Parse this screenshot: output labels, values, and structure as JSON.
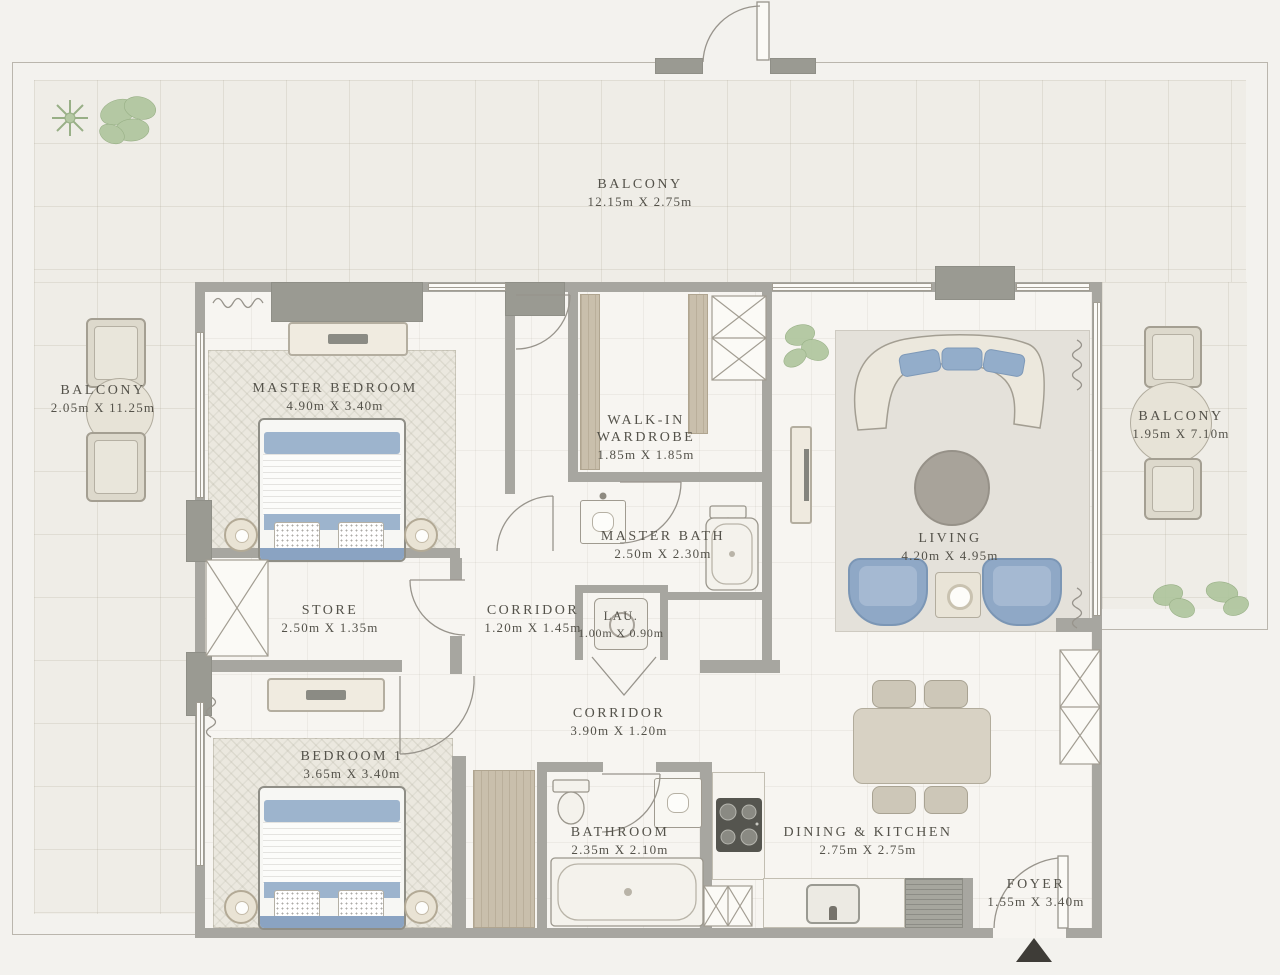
{
  "plan_type": "apartment-floor-plan",
  "rooms": [
    {
      "id": "balcony-top",
      "name": "BALCONY",
      "dims": "12.15m X 2.75m"
    },
    {
      "id": "balcony-left",
      "name": "BALCONY",
      "dims": "2.05m X 11.25m"
    },
    {
      "id": "master-bedroom",
      "name": "MASTER BEDROOM",
      "dims": "4.90m X 3.40m"
    },
    {
      "id": "walk-in-wardrobe",
      "name": "WALK-IN WARDROBE",
      "dims": "1.85m X 1.85m"
    },
    {
      "id": "balcony-right",
      "name": "BALCONY",
      "dims": "1.95m X 7.10m"
    },
    {
      "id": "master-bath",
      "name": "MASTER BATH",
      "dims": "2.50m X 2.30m"
    },
    {
      "id": "living",
      "name": "LIVING",
      "dims": "4.20m X 4.95m"
    },
    {
      "id": "store",
      "name": "STORE",
      "dims": "2.50m X 1.35m"
    },
    {
      "id": "corridor-1",
      "name": "CORRIDOR",
      "dims": "1.20m X 1.45m"
    },
    {
      "id": "laundry",
      "name": "LAU.",
      "dims": "1.00m X 0.90m"
    },
    {
      "id": "corridor-2",
      "name": "CORRIDOR",
      "dims": "3.90m X 1.20m"
    },
    {
      "id": "bedroom-1",
      "name": "BEDROOM 1",
      "dims": "3.65m X 3.40m"
    },
    {
      "id": "bathroom",
      "name": "BATHROOM",
      "dims": "2.35m X 2.10m"
    },
    {
      "id": "dining-kitchen",
      "name": "DINING & KITCHEN",
      "dims": "2.75m X 2.75m"
    },
    {
      "id": "foyer",
      "name": "FOYER",
      "dims": "1.55m X 3.40m"
    }
  ],
  "colors": {
    "background": "#f3f2ee",
    "wall": "#a7a6a0",
    "text": "#54524a",
    "accent_blue": "#8fa8c6",
    "wood": "#c9bfac",
    "plant_green": "#aec59c",
    "entry_marker": "#3e3c37"
  }
}
